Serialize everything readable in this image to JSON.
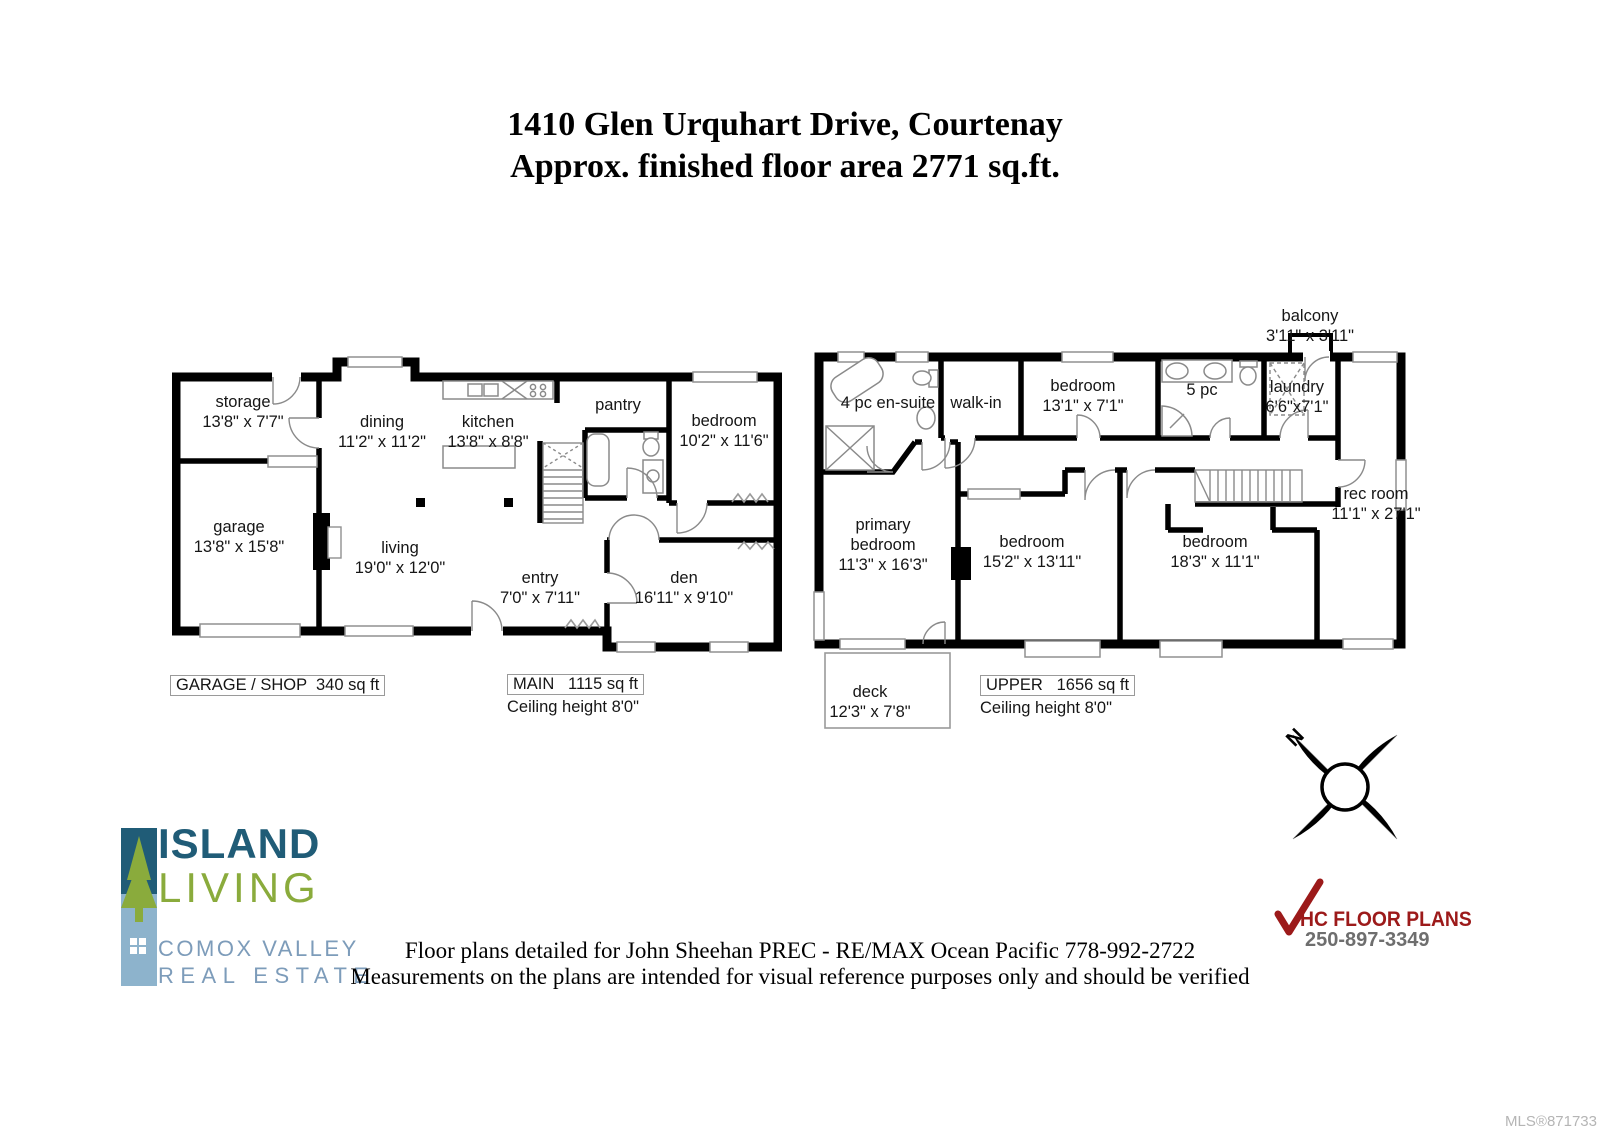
{
  "title": {
    "line1": "1410 Glen Urquhart Drive, Courtenay",
    "line2": "Approx. finished floor area 2771 sq.ft."
  },
  "main_floor": {
    "rooms": {
      "storage": {
        "name": "storage",
        "dims": "13'8\" x 7'7\""
      },
      "garage": {
        "name": "garage",
        "dims": "13'8\" x 15'8\""
      },
      "dining": {
        "name": "dining",
        "dims": "11'2\" x 11'2\""
      },
      "kitchen": {
        "name": "kitchen",
        "dims": "13'8\" x 8'8\""
      },
      "pantry": {
        "name": "pantry",
        "dims": ""
      },
      "bedroom": {
        "name": "bedroom",
        "dims": "10'2\" x 11'6\""
      },
      "living": {
        "name": "living",
        "dims": "19'0\" x 12'0\""
      },
      "entry": {
        "name": "entry",
        "dims": "7'0\" x 7'11\""
      },
      "den": {
        "name": "den",
        "dims": "16'11\" x 9'10\""
      }
    },
    "garage_label": "GARAGE / SHOP  340 sq ft",
    "area_label": "MAIN   1115 sq ft",
    "ceiling_label": "Ceiling height 8'0\""
  },
  "upper_floor": {
    "rooms": {
      "balcony": {
        "name": "balcony",
        "dims": "3'11\" x 3'11\""
      },
      "ensuite": {
        "name": "4 pc en-suite",
        "dims": ""
      },
      "walkin": {
        "name": "walk-in",
        "dims": ""
      },
      "bedroom1": {
        "name": "bedroom",
        "dims": "13'1\" x 7'1\""
      },
      "bath5pc": {
        "name": "5 pc",
        "dims": ""
      },
      "laundry": {
        "name": "laundry",
        "dims": "6'6\"x7'1\""
      },
      "recroom": {
        "name": "rec room",
        "dims": "11'1\" x 27'1\""
      },
      "primary": {
        "name": "primary bedroom",
        "dims": "11'3\" x 16'3\""
      },
      "bedroom2": {
        "name": "bedroom",
        "dims": "15'2\" x 13'11\""
      },
      "bedroom3": {
        "name": "bedroom",
        "dims": "18'3\" x 11'1\""
      },
      "deck": {
        "name": "deck",
        "dims": "12'3\" x 7'8\""
      }
    },
    "area_label": "UPPER   1656 sq ft",
    "ceiling_label": "Ceiling height 8'0\""
  },
  "compass": {
    "north_label": "N"
  },
  "branding": {
    "island_living": {
      "line1": "ISLAND",
      "line2": "LIVING",
      "line3": "COMOX VALLEY",
      "line4": "REAL ESTATE",
      "teal": "#205c77",
      "green": "#8aab3c",
      "slate": "#7d9cba"
    },
    "hc_floor_plans": {
      "name": "HC FLOOR PLANS",
      "phone": "250-897-3349",
      "red": "#9c1a1a",
      "gray": "#6e6e6e"
    }
  },
  "footer": {
    "line1": "Floor plans detailed for John Sheehan PREC - RE/MAX Ocean Pacific 778-992-2722",
    "line2": "Measurements on the plans are intended for visual reference purposes only and should be verified"
  },
  "mls": "MLS®871733"
}
